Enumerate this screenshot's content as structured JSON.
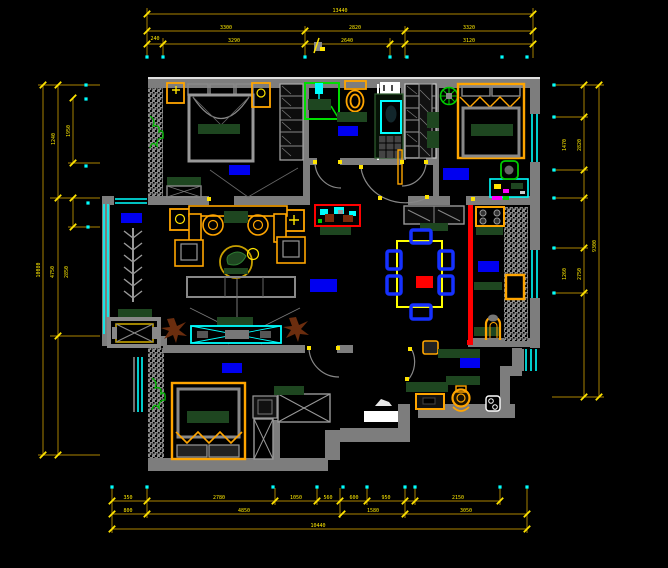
{
  "app": {
    "type": "cad-floor-plan-view",
    "background": "#000000"
  },
  "palette": {
    "wall_gray": "#7d7d7d",
    "dim_line": "#8a6a00",
    "dim_text": "#ffe900",
    "window_cyan": "#00ffff",
    "furniture_orange": "#ffa500",
    "soft_furnishing_green": "#1e4620",
    "room_label_blue": "#0000f0",
    "highlight_red": "#ff0000",
    "plant_green": "#00bb00",
    "plant_brown": "#6b2d0e"
  },
  "dimensions": {
    "top": {
      "total": "13440",
      "row2": [
        "3300",
        "2820",
        "3320"
      ],
      "row3": [
        "240",
        "3290",
        "2640",
        "3120"
      ]
    },
    "bottom": {
      "row1": [
        "350",
        "2780",
        "1050",
        "560",
        "600",
        "950",
        "2150"
      ],
      "row2": [
        "800",
        "4850",
        "1580",
        "3050"
      ],
      "total": "10440"
    },
    "left": {
      "total": "10080",
      "inner": [
        "4750",
        "2850"
      ],
      "sub": [
        "1950",
        "1240"
      ]
    },
    "right": {
      "total": "9300",
      "upper": [
        "1470",
        "2820"
      ],
      "lower": [
        "1260",
        "2750"
      ]
    }
  },
  "rooms": [
    {
      "id": "bedroom-top-left"
    },
    {
      "id": "bathroom"
    },
    {
      "id": "bedroom-top-right"
    },
    {
      "id": "living-room"
    },
    {
      "id": "balcony"
    },
    {
      "id": "dining-area"
    },
    {
      "id": "kitchen"
    },
    {
      "id": "entry"
    },
    {
      "id": "bedroom-bottom"
    }
  ]
}
